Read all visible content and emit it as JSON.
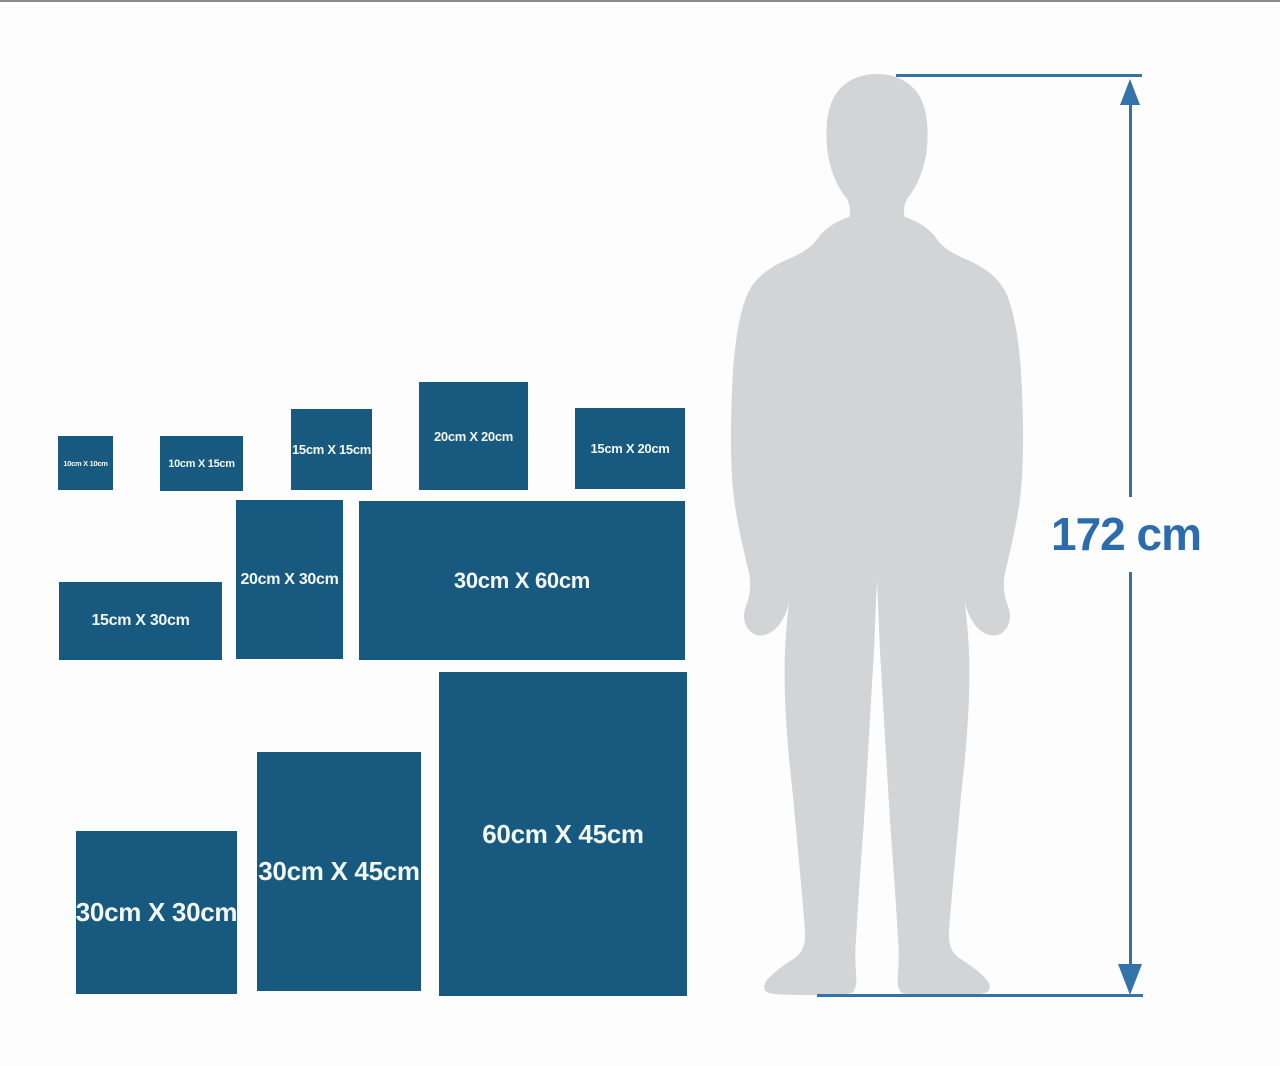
{
  "size_chart": {
    "boxes": [
      {
        "id": "10x10",
        "label": "10cm X 10cm"
      },
      {
        "id": "10x15",
        "label": "10cm X 15cm"
      },
      {
        "id": "15x15",
        "label": "15cm X 15cm"
      },
      {
        "id": "20x20",
        "label": "20cm X 20cm"
      },
      {
        "id": "15x20",
        "label": "15cm X 20cm"
      },
      {
        "id": "15x30",
        "label": "15cm X 30cm"
      },
      {
        "id": "20x30",
        "label": "20cm X 30cm"
      },
      {
        "id": "30x60",
        "label": "30cm X 60cm"
      },
      {
        "id": "30x30",
        "label": "30cm X 30cm"
      },
      {
        "id": "30x45",
        "label": "30cm X 45cm"
      },
      {
        "id": "60x45",
        "label": "60cm X 45cm"
      }
    ]
  },
  "person": {
    "height_label": "172 cm",
    "silhouette": "standing-man-silhouette"
  },
  "colors": {
    "box_blue": "#185a7f",
    "box_label_white": "#f2f7f2",
    "dimension_line_blue": "#3473aa",
    "height_text_blue": "#2d6cac",
    "silhouette_gray": "#d2d4d5",
    "background": "#fdfdfd",
    "top_border_gray": "#8a8a8a"
  }
}
